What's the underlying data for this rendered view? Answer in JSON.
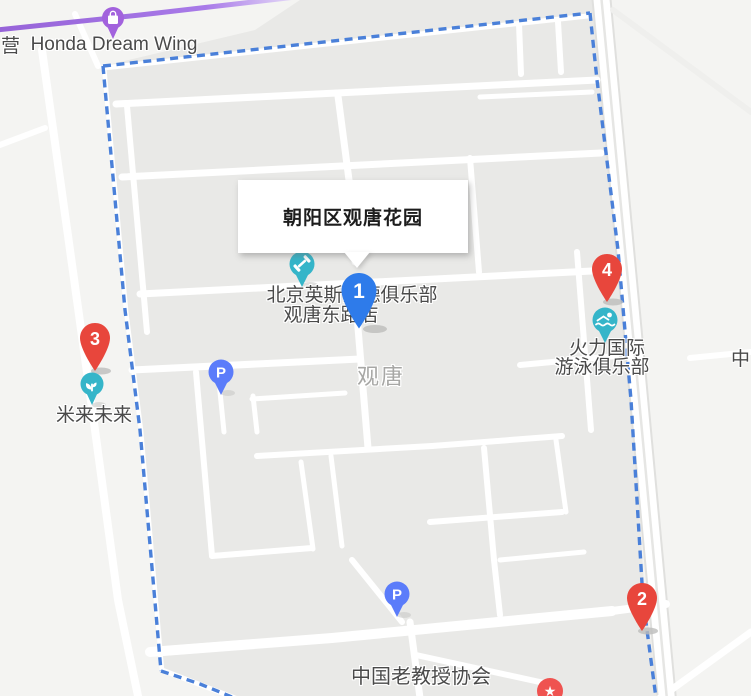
{
  "info_box": {
    "title": "朝阳区观唐花园"
  },
  "area_label": "观唐",
  "edge_labels": {
    "left": "营",
    "right": "中"
  },
  "pois": {
    "honda": {
      "label": "Honda Dream Wing"
    },
    "club": {
      "line1": "北京英斯派德俱乐部",
      "line2": "观唐东路店"
    },
    "swim": {
      "line1": "火力国际",
      "line2": "游泳俱乐部"
    },
    "milai": {
      "label": "米来未来"
    },
    "professors": {
      "label": "中国老教授协会"
    },
    "parking1": {
      "glyph": "P"
    },
    "parking2": {
      "glyph": "P"
    }
  },
  "markers": {
    "m1": {
      "number": "1"
    },
    "m2": {
      "number": "2"
    },
    "m3": {
      "number": "3"
    },
    "m4": {
      "number": "4"
    }
  },
  "colors": {
    "boundary_dash": "#4a80d9",
    "selected_marker_blue": "#2e7bea",
    "numbered_marker_red": "#e8463c",
    "poi_teal": "#35b5c9",
    "parking_blue": "#5b7cfa",
    "honda_purple": "#a262dd",
    "highway_purple": "#9d6ce0",
    "star_red": "#ef5350",
    "block_gray": "#e9e9e7",
    "outside_gray": "#f4f4f2"
  }
}
